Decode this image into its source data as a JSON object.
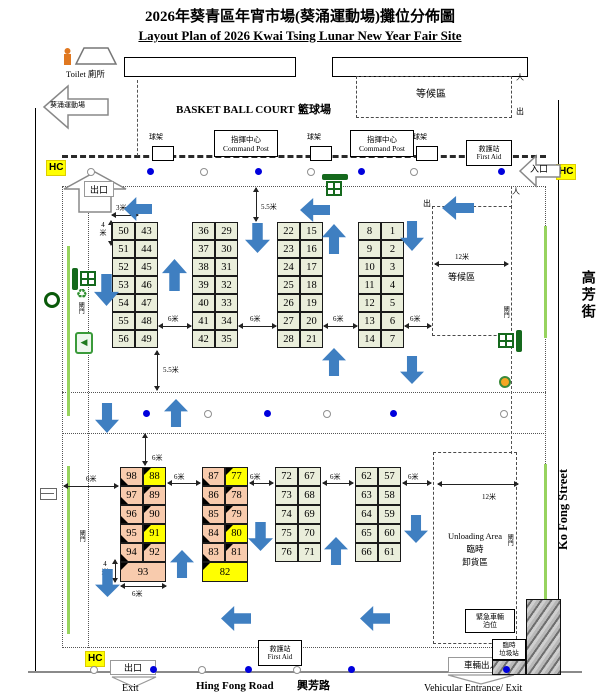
{
  "title": "2026年葵青區年宵市場(葵涌運動場)攤位分佈圖",
  "subtitle": "Layout Plan of 2026 Kwai Tsing Lunar New Year Fair Site",
  "colors": {
    "stall_green": "#eaeedb",
    "stall_peach": "#f8cbad",
    "highlight_yellow": "#ffff00",
    "arrow_blue": "#3f7fc1",
    "icon_green": "#15691d",
    "dot_blue": "#0000dd",
    "hc_yellow": "#ffff00"
  },
  "landmarks": {
    "toilet": "Toilet 廁所",
    "sports_ground": "葵涌運動場",
    "basketball_en": "BASKET BALL COURT",
    "basketball_zh": "籃球場",
    "waiting_area": "等候區",
    "ball_rack": "球架",
    "command_post_zh": "指揮中心",
    "command_post_en": "Command Post",
    "first_aid_zh": "救護站",
    "first_aid_en": "First Aid",
    "unloading_en": "Unloading Area",
    "unloading_zh1": "臨時",
    "unloading_zh2": "卸貨區",
    "emergency_zh1": "緊急車輛",
    "emergency_zh2": "泊位",
    "refuse_zh1": "臨時",
    "refuse_zh2": "垃圾站",
    "gate": "閘門"
  },
  "gates": {
    "hc": "HC",
    "exit_zh": "出口",
    "exit_en": "Exit",
    "entrance_zh": "入口",
    "vehicular_zh": "車輛出入",
    "vehicular_en": "Vehicular Entrance/ Exit",
    "person": "人",
    "out": "出"
  },
  "streets": {
    "bottom_en": "Hing Fong Road",
    "bottom_zh": "興芳路",
    "right_zh": "高芳街",
    "right_en": "Ko Fong Street"
  },
  "dims": {
    "m3": "3米",
    "m4": "4米",
    "m55": "5.5米",
    "m6": "6米",
    "m12": "12米"
  },
  "stalls": {
    "upper_groups": [
      {
        "left": [
          50,
          51,
          52,
          53,
          54,
          55,
          56
        ],
        "right": [
          43,
          44,
          45,
          46,
          47,
          48,
          49
        ]
      },
      {
        "left": [
          36,
          37,
          38,
          39,
          40,
          41,
          42
        ],
        "right": [
          29,
          30,
          31,
          32,
          33,
          34,
          35
        ]
      },
      {
        "left": [
          22,
          23,
          24,
          25,
          26,
          27,
          28
        ],
        "right": [
          15,
          16,
          17,
          18,
          19,
          20,
          21
        ]
      },
      {
        "left": [
          8,
          9,
          10,
          11,
          12,
          13,
          14
        ],
        "right": [
          1,
          2,
          3,
          4,
          5,
          6,
          7
        ]
      }
    ],
    "lower_groups": [
      {
        "left": [
          98,
          97,
          96,
          95,
          94
        ],
        "right": [
          88,
          89,
          90,
          91,
          92
        ],
        "wide": 93,
        "highlight": [
          88,
          91
        ]
      },
      {
        "left": [
          87,
          86,
          85,
          84,
          83
        ],
        "right": [
          77,
          78,
          79,
          80,
          81
        ],
        "wide": 82,
        "highlight": [
          77,
          80,
          82
        ]
      },
      {
        "left": [
          72,
          73,
          74,
          75,
          76
        ],
        "right": [
          67,
          68,
          69,
          70,
          71
        ]
      },
      {
        "left": [
          62,
          63,
          64,
          65,
          66
        ],
        "right": [
          57,
          58,
          59,
          60,
          61
        ]
      }
    ]
  }
}
